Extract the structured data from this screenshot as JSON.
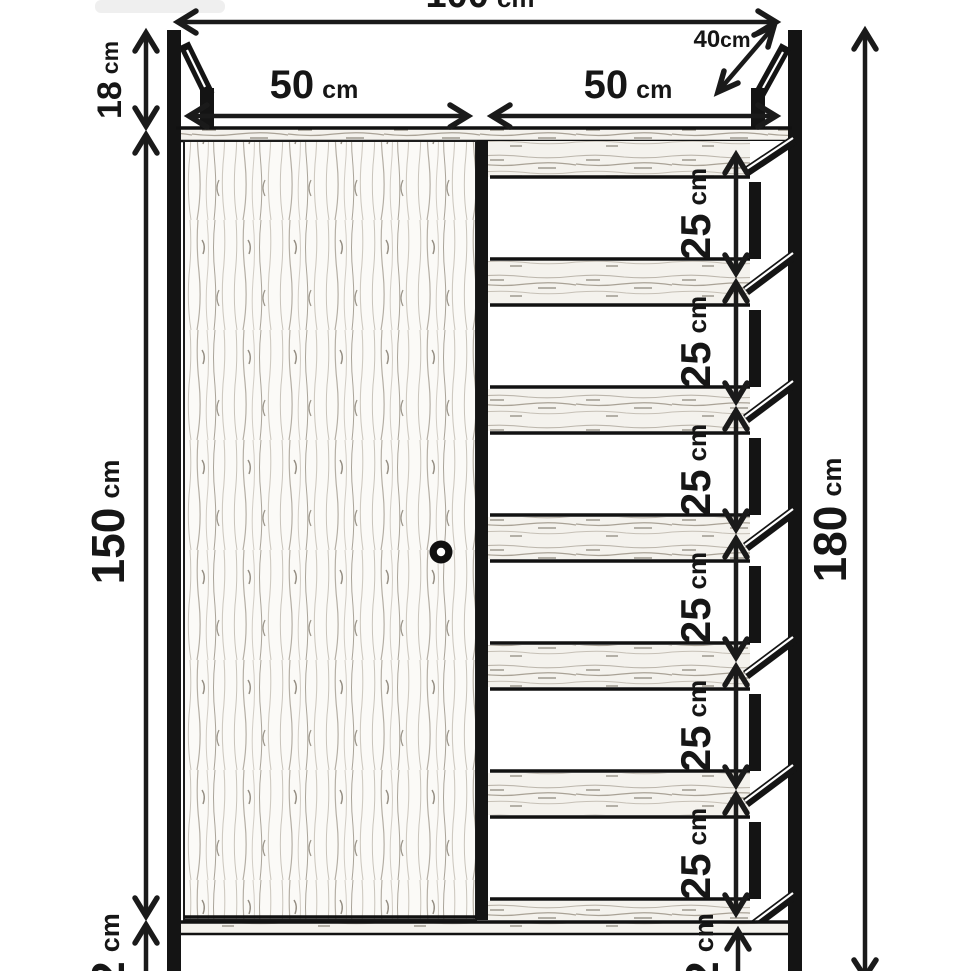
{
  "diagram": {
    "kind": "furniture dimension drawing",
    "subject": "wardrobe with door and open shelves",
    "unit": "cm",
    "ink_color": "#1a1a1a",
    "wood_light": "#f7f5f1",
    "dimensions": {
      "top_width": {
        "value": "100",
        "unit": "cm"
      },
      "top_section_height": {
        "value": "18",
        "unit": "cm"
      },
      "depth": {
        "value": "40",
        "unit": "cm"
      },
      "door_width": {
        "value": "50",
        "unit": "cm"
      },
      "shelf_width": {
        "value": "50",
        "unit": "cm"
      },
      "body_height": {
        "value": "150",
        "unit": "cm"
      },
      "total_height": {
        "value": "180",
        "unit": "cm"
      },
      "shelf_gaps": [
        {
          "value": "25",
          "unit": "cm"
        },
        {
          "value": "25",
          "unit": "cm"
        },
        {
          "value": "25",
          "unit": "cm"
        },
        {
          "value": "25",
          "unit": "cm"
        },
        {
          "value": "25",
          "unit": "cm"
        },
        {
          "value": "25",
          "unit": "cm"
        }
      ],
      "plinth_left": {
        "value": "2",
        "unit": "cm"
      },
      "plinth_right": {
        "value": "2",
        "unit": "cm"
      }
    }
  }
}
